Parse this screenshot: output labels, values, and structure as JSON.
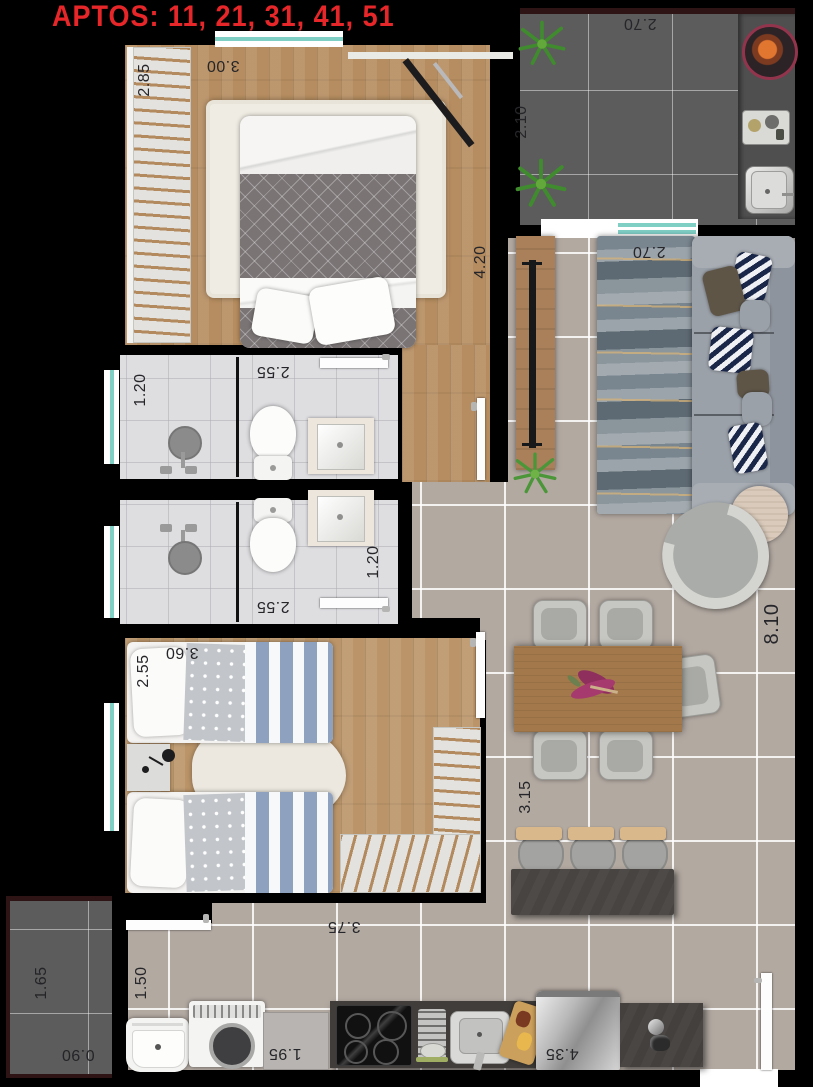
{
  "title": "APTOS: 11, 21, 31, 41, 51",
  "colors": {
    "accent_red": "#e62629",
    "window_teal": "#7fcfc5",
    "exterior_wall_maroon": "#2f1416",
    "floor_tile_beige": "#b2a9a1",
    "balcony_tile_gray": "#5c5c5c",
    "wood_floor": "#b68d60"
  },
  "dims": {
    "balcony_width": "2.70",
    "balcony_depth": "2.10",
    "bedroom1_wardrobe": "2.85",
    "bedroom1_width": "3.00",
    "bedroom1_length": "4.20",
    "bath1_width": "1.20",
    "bath1_length": "2.55",
    "bath2_length": "2.55",
    "bath2_width": "1.20",
    "living_width": "2.70",
    "living_length": "8.10",
    "dining_width": "3.15",
    "bedroom2_width": "2.55",
    "bedroom2_length": "3.60",
    "kitchen_width": "3.75",
    "kitchen_length": "4.35",
    "laundry_width": "1.50",
    "laundry_length": "1.95",
    "service_length": "1.65",
    "service_width": "0.90"
  }
}
